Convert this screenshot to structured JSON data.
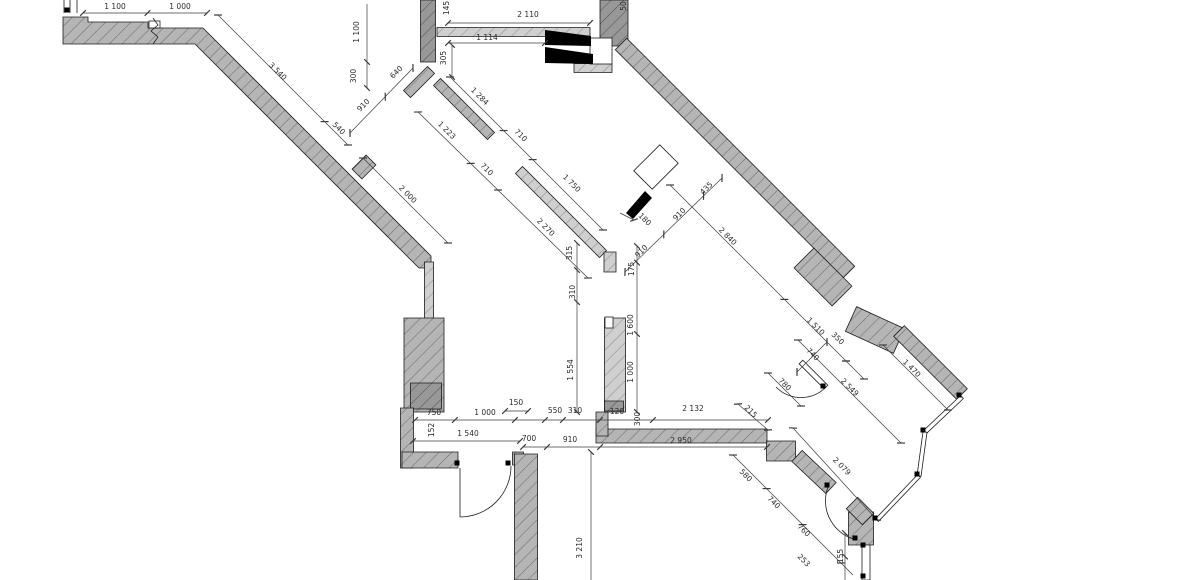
{
  "drawing": {
    "canvas": {
      "w": 1200,
      "h": 580,
      "bg": "#ffffff"
    },
    "colors": {
      "wall": "#b5b5b5",
      "wall_dark": "#989898",
      "wall_light": "#cfcfcf",
      "hatch": "#6e6e6e",
      "hatch_dark": "#555555",
      "hatch_light": "#8f8f8f",
      "outline": "#1c1c1c",
      "dim": "#3c3c3c",
      "text": "#2a2a2a",
      "symbol": "#000000"
    },
    "wall_polys": [
      {
        "tone": "wall",
        "pts": [
          [
            63,
            17
          ],
          [
            88,
            17
          ],
          [
            88,
            22
          ],
          [
            148,
            22
          ],
          [
            148,
            28
          ],
          [
            203,
            28
          ],
          [
            431,
            256
          ],
          [
            431,
            268
          ],
          [
            419,
            268
          ],
          [
            195,
            44
          ],
          [
            63,
            44
          ]
        ]
      }
    ],
    "wall_bands": [
      [
        357,
        174,
        371,
        160,
        14,
        "wall"
      ],
      [
        429,
        262,
        429,
        320,
        9,
        "light"
      ],
      [
        424,
        318,
        424,
        412,
        40,
        "wall"
      ],
      [
        426,
        383,
        426,
        409,
        31,
        "dark"
      ],
      [
        407,
        408,
        407,
        468,
        13,
        "wall"
      ],
      [
        402,
        460,
        458,
        460,
        16,
        "wall"
      ],
      [
        518,
        452,
        518,
        465,
        11,
        "wall"
      ],
      [
        526,
        454,
        526,
        580,
        23,
        "wall"
      ],
      [
        428,
        0,
        428,
        62,
        15,
        "dark"
      ],
      [
        431,
        70,
        407,
        94,
        10,
        "wall"
      ],
      [
        437,
        82,
        491,
        136,
        10,
        "wall"
      ],
      [
        437,
        32,
        590,
        32,
        9,
        "light"
      ],
      [
        574,
        68,
        612,
        68,
        9,
        "light"
      ],
      [
        519,
        170,
        603,
        254,
        10,
        "light"
      ],
      [
        610,
        252,
        610,
        272,
        12,
        "light"
      ],
      [
        614,
        0,
        614,
        46,
        28,
        "dark"
      ],
      [
        621,
        44,
        849,
        272,
        16,
        "wall"
      ],
      [
        804,
        258,
        842,
        296,
        28,
        "wall"
      ],
      [
        851,
        319,
        899,
        341,
        27,
        "wall"
      ],
      [
        899,
        331,
        962,
        394,
        15,
        "wall"
      ],
      [
        596,
        436,
        767,
        436,
        14,
        "wall"
      ],
      [
        602,
        412,
        602,
        436,
        12,
        "wall"
      ],
      [
        781,
        441,
        781,
        461,
        29,
        "wall"
      ],
      [
        797,
        456,
        831,
        488,
        15,
        "wall"
      ],
      [
        861,
        512,
        861,
        545,
        25,
        "wall"
      ],
      [
        852,
        503,
        868,
        519,
        16,
        "wall"
      ],
      [
        615,
        318,
        615,
        412,
        21,
        "light"
      ],
      [
        614,
        401,
        614,
        411,
        19,
        "dark"
      ]
    ],
    "white_boxes": [
      [
        590,
        38,
        22,
        26
      ],
      [
        605,
        317,
        8,
        11
      ],
      [
        149,
        21,
        11,
        7
      ]
    ],
    "windows": [
      [
        962,
        397,
        925,
        432,
        4
      ],
      [
        925,
        432,
        919,
        476,
        4
      ],
      [
        919,
        476,
        877,
        520,
        4
      ],
      [
        866,
        545,
        866,
        580,
        8
      ],
      [
        801,
        362,
        826,
        387,
        5
      ],
      [
        643,
        180,
        669,
        154,
        26
      ]
    ],
    "door_leaf_symbols": [
      [
        [
          545,
          30
        ],
        [
          591,
          36
        ],
        [
          591,
          46
        ],
        [
          545,
          45
        ]
      ],
      [
        [
          545,
          47
        ],
        [
          593,
          54
        ],
        [
          593,
          64
        ],
        [
          545,
          63
        ]
      ],
      [
        [
          626,
          213
        ],
        [
          645,
          191
        ],
        [
          652,
          198
        ],
        [
          633,
          219
        ]
      ]
    ],
    "door_arcs": [
      "M 511 466 A 51 51 0 0 1 460 517",
      "M 826 387 A 35 35 0 0 1 776 387",
      "M 828 487 A 40 40 0 0 0 857 540"
    ],
    "misc_lines": [
      [
        64,
        0,
        64,
        13
      ],
      [
        70,
        0,
        70,
        13
      ],
      [
        77,
        0,
        77,
        13
      ],
      [
        460,
        468,
        460,
        517
      ]
    ],
    "squiggle": "M 153 18 l 5 7 l -7 6 l 7 6 l -5 7",
    "joint_dots": [
      [
        67,
        10
      ],
      [
        457,
        463
      ],
      [
        508,
        463
      ],
      [
        923,
        430
      ],
      [
        917,
        474
      ],
      [
        875,
        518
      ],
      [
        959,
        395
      ],
      [
        823,
        386
      ],
      [
        827,
        485
      ],
      [
        855,
        538
      ],
      [
        863,
        545
      ],
      [
        863,
        576
      ]
    ],
    "dimlines": [
      [
        83,
        13,
        207,
        13,
        [
          0,
          0.52,
          1
        ]
      ],
      [
        218,
        15,
        348,
        145,
        [
          0,
          0.82,
          1
        ]
      ],
      [
        350,
        133,
        413,
        68,
        [
          0,
          0.56,
          1
        ]
      ],
      [
        367,
        4,
        367,
        88,
        [
          0.69,
          1
        ]
      ],
      [
        448,
        23,
        590,
        23,
        [
          0,
          1
        ]
      ],
      [
        448,
        43,
        545,
        43,
        [
          0,
          1
        ]
      ],
      [
        452,
        45,
        452,
        77,
        [
          0,
          1
        ]
      ],
      [
        450,
        77,
        603,
        230,
        [
          0,
          0.35,
          0.54,
          1
        ]
      ],
      [
        418,
        112,
        588,
        278,
        [
          0,
          0.31,
          0.47,
          1
        ]
      ],
      [
        363,
        158,
        448,
        243,
        [
          0,
          1
        ]
      ],
      [
        625,
        272,
        722,
        178,
        [
          0,
          0.4,
          0.81,
          1
        ]
      ],
      [
        670,
        185,
        846,
        361,
        [
          0,
          0.65,
          1
        ]
      ],
      [
        846,
        361,
        864,
        379,
        [
          0,
          1
        ]
      ],
      [
        797,
        372,
        827,
        342,
        [
          0,
          1
        ]
      ],
      [
        883,
        345,
        948,
        410,
        [
          0,
          1
        ]
      ],
      [
        798,
        340,
        901,
        443,
        [
          0,
          1
        ]
      ],
      [
        768,
        373,
        801,
        406,
        [
          0,
          1
        ]
      ],
      [
        793,
        428,
        877,
        520,
        [
          0,
          1
        ]
      ],
      [
        738,
        404,
        768,
        430,
        [
          0,
          1
        ]
      ],
      [
        733,
        455,
        853,
        575,
        [
          0,
          0.28,
          0.58,
          0.9
        ]
      ],
      [
        415,
        420,
        768,
        420,
        [
          0,
          0.113,
          0.283,
          0.368,
          0.419,
          0.524,
          0.674,
          1
        ]
      ],
      [
        505,
        411,
        528,
        411,
        [
          0,
          1
        ]
      ],
      [
        413,
        441,
        520,
        441,
        [
          0,
          1
        ]
      ],
      [
        523,
        447,
        767,
        447,
        [
          0,
          0.098,
          0.316,
          1
        ]
      ],
      [
        591,
        452,
        591,
        580,
        [
          0
        ]
      ],
      [
        845,
        533,
        845,
        580,
        [
          0,
          0.5
        ]
      ],
      [
        577,
        243,
        577,
        412,
        [
          0,
          0.16,
          0.35,
          1
        ]
      ],
      [
        637,
        246,
        637,
        412,
        [
          0,
          0.1,
          0.53,
          1
        ]
      ],
      [
        620,
        213,
        634,
        220,
        [
          1
        ]
      ]
    ],
    "labels": [
      [
        "1 100",
        115,
        9,
        0
      ],
      [
        "1 000",
        180,
        9,
        0
      ],
      [
        "3 540",
        276,
        73,
        45
      ],
      [
        "540",
        337,
        130,
        45
      ],
      [
        "910",
        365,
        107,
        -45
      ],
      [
        "640",
        398,
        74,
        -45
      ],
      [
        "1 100",
        359,
        32,
        -90
      ],
      [
        "300",
        356,
        76,
        -90
      ],
      [
        "145",
        449,
        8,
        -90
      ],
      [
        "50",
        626,
        6,
        -90
      ],
      [
        "2 110",
        528,
        17,
        0
      ],
      [
        "1 114",
        487,
        40,
        0
      ],
      [
        "305",
        446,
        58,
        -90
      ],
      [
        "1 284",
        478,
        98,
        45
      ],
      [
        "710",
        519,
        137,
        45
      ],
      [
        "1 750",
        570,
        185,
        45
      ],
      [
        "1 223",
        445,
        132,
        45
      ],
      [
        "710",
        485,
        171,
        45
      ],
      [
        "2 270",
        544,
        229,
        45
      ],
      [
        "2 000",
        406,
        196,
        45
      ],
      [
        "180",
        643,
        221,
        45
      ],
      [
        "910",
        681,
        216,
        -45
      ],
      [
        "910",
        643,
        253,
        -45
      ],
      [
        "435",
        708,
        190,
        -45
      ],
      [
        "2 840",
        726,
        238,
        45
      ],
      [
        "1 510",
        814,
        328,
        45
      ],
      [
        "350",
        836,
        340,
        45
      ],
      [
        "740",
        811,
        356,
        45
      ],
      [
        "1 470",
        910,
        370,
        45
      ],
      [
        "2 549",
        848,
        389,
        45
      ],
      [
        "780",
        783,
        386,
        45
      ],
      [
        "2 079",
        840,
        468,
        45
      ],
      [
        "215",
        749,
        413,
        45
      ],
      [
        "580",
        744,
        477,
        45
      ],
      [
        "740",
        772,
        504,
        45
      ],
      [
        "760",
        802,
        532,
        45
      ],
      [
        "253",
        802,
        562,
        45
      ],
      [
        "155",
        843,
        556,
        -90
      ],
      [
        "750",
        434,
        415,
        0
      ],
      [
        "1 000",
        485,
        415,
        0
      ],
      [
        "150",
        516,
        405,
        0
      ],
      [
        "550",
        555,
        413,
        0
      ],
      [
        "310",
        575,
        413,
        0
      ],
      [
        "120",
        617,
        414,
        0
      ],
      [
        "300",
        640,
        419,
        -90
      ],
      [
        "2 132",
        693,
        411,
        0
      ],
      [
        "1 540",
        468,
        436,
        0
      ],
      [
        "152",
        434,
        430,
        -90
      ],
      [
        "700",
        529,
        441,
        0
      ],
      [
        "910",
        570,
        442,
        0
      ],
      [
        "2 950",
        681,
        443,
        0
      ],
      [
        "3 210",
        582,
        548,
        -90
      ],
      [
        "315",
        572,
        253,
        -90
      ],
      [
        "310",
        575,
        292,
        -90
      ],
      [
        "1 554",
        573,
        370,
        -90
      ],
      [
        "175",
        634,
        269,
        -90
      ],
      [
        "1 600",
        633,
        325,
        -90
      ],
      [
        "1 000",
        633,
        372,
        -90
      ]
    ]
  }
}
